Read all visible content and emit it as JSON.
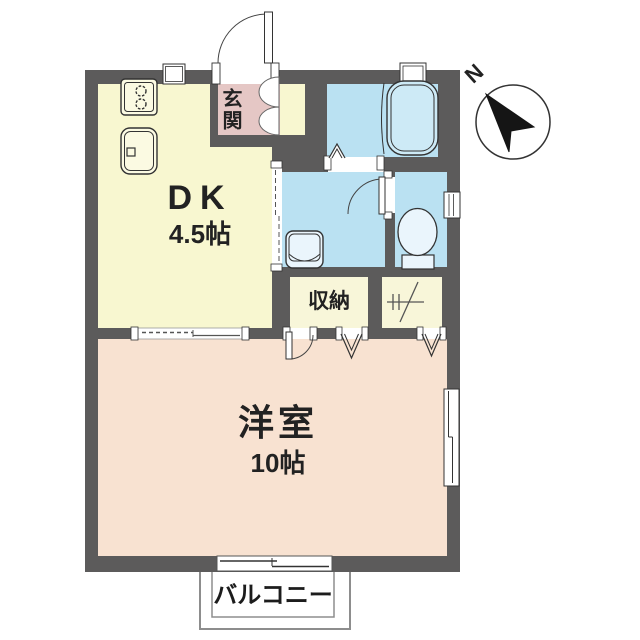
{
  "title": "apartment-floor-plan",
  "compass": {
    "label": "N"
  },
  "rooms": {
    "dk": {
      "name": "DK",
      "size": "4.5帖"
    },
    "genkan": {
      "name": "玄関"
    },
    "storage": {
      "name": "収納"
    },
    "western_room": {
      "name": "洋室",
      "size": "10帖"
    },
    "balcony": {
      "name": "バルコニー"
    }
  },
  "fixtures": [
    "stove",
    "kitchen-sink",
    "bathtub",
    "folding-bath-door",
    "washbasin",
    "toilet",
    "shoe-cabinet",
    "water-heater-space",
    "sliding-doors",
    "windows",
    "north-arrow"
  ],
  "colors": {
    "wall": "#5c5b5b",
    "dk-floor": "#f8f7d0",
    "storage-floor": "#f8f6d9",
    "genkan-floor": "#e5c7c5",
    "water-floor": "#bae1f2",
    "western-floor": "#f8e2d1",
    "balcony-line": "#8d8d8d",
    "line": "#333333",
    "text": "#222222"
  }
}
